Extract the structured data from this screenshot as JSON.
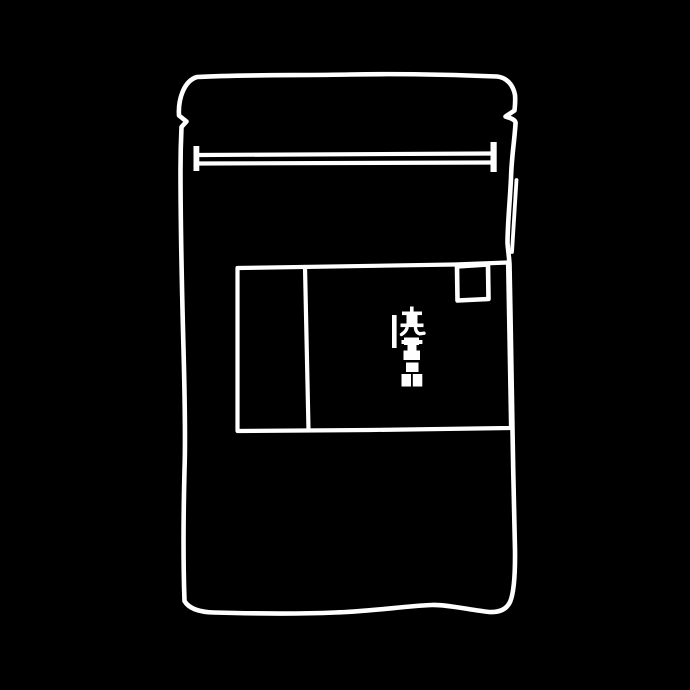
{
  "scene": {
    "description": "Hand-drawn white line sketch of a resealable stand-up pouch package on a black background",
    "background_color": "#000000",
    "line_color": "#ffffff"
  },
  "pouch": {
    "zip_seal": {
      "style": "double horizontal line with vertical end caps"
    },
    "tear_notches": [
      "left",
      "right"
    ],
    "label": {
      "sections": [
        "left-panel",
        "main-panel"
      ],
      "corner_square": "small square at top-right of label",
      "vertical_text": {
        "first_char": "売",
        "glyph_count": 3,
        "orientation": "vertical",
        "accent": "short vertical rule left of text"
      }
    }
  }
}
